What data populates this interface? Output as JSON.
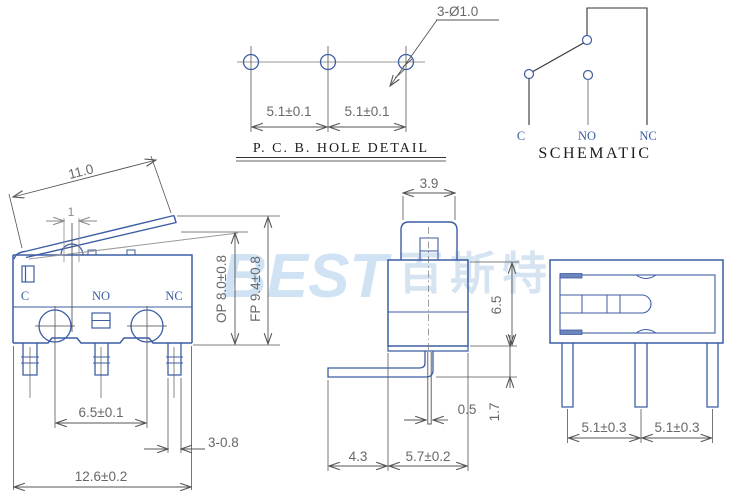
{
  "pcb_detail": {
    "title": "P. C. B.  HOLE DETAIL",
    "hole_label": "3-Ø1.0",
    "pitch_left": "5.1±0.1",
    "pitch_right": "5.1±0.1"
  },
  "schematic": {
    "title": "SCHEMATIC",
    "terminals": [
      "C",
      "NO",
      "NC"
    ]
  },
  "front_view": {
    "lever_length": "11.0",
    "plunger_width": "1",
    "terminals": [
      "C",
      "NO",
      "NC"
    ],
    "op_height": "OP 8.0±0.8",
    "fp_height": "FP 9.4±0.8",
    "hole_span": "6.5±0.1",
    "pin_width": "3-0.8",
    "body_width": "12.6±0.2"
  },
  "side_view": {
    "lever_width": "3.9",
    "body_height": "6.5",
    "pin_thickness": "0.5",
    "lever_overhang": "4.3",
    "body_depth": "5.7±0.2",
    "lever_drop": "1.7"
  },
  "bottom_view": {
    "pitch_left": "5.1±0.3",
    "pitch_right": "5.1±0.3"
  },
  "watermark": {
    "logo": "BEST",
    "cn": "百斯特"
  },
  "colors": {
    "line_blue": "#3c5da3",
    "dim_gray": "#686868",
    "construction_gray": "#999999",
    "watermark_blue": "#cfe3f4"
  }
}
